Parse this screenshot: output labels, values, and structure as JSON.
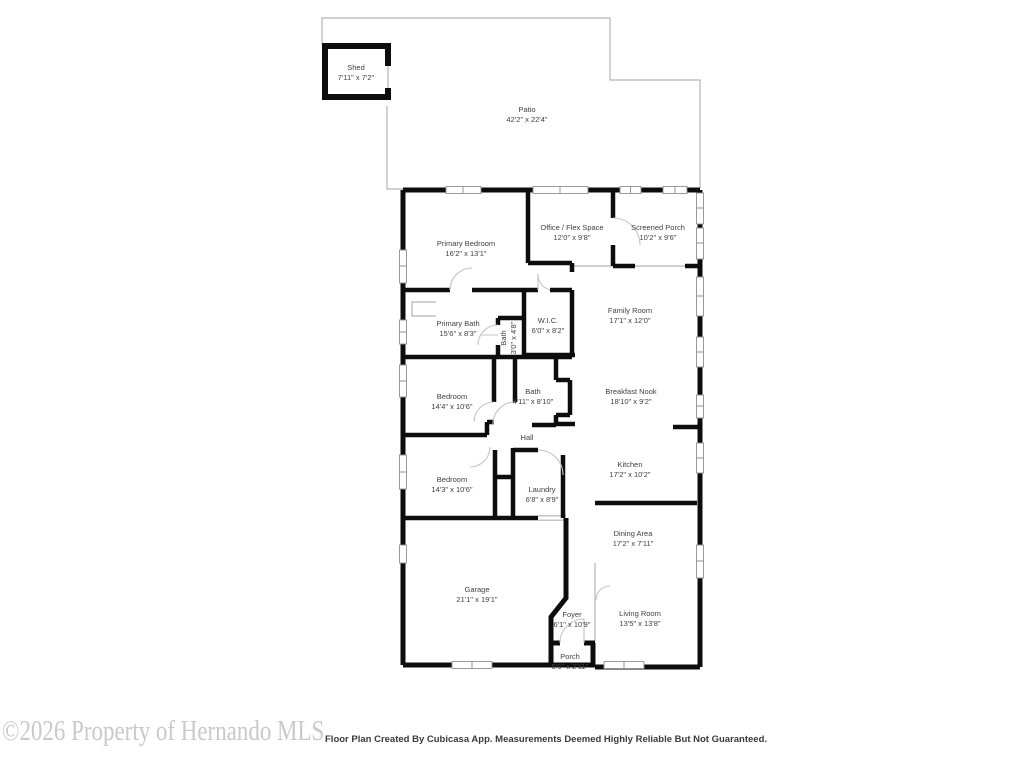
{
  "footer": {
    "watermark": "©2026 Property of Hernando MLS",
    "disclaimer": "Floor Plan Created By Cubicasa App. Measurements Deemed Highly Reliable But Not Guaranteed."
  },
  "colors": {
    "wall": "#0d0d0d",
    "window_outline": "#8f8f8f",
    "patio_outline": "#b3b3b3",
    "label_text": "#3f3f3f",
    "watermark_text": "#c9c9c9",
    "disclaimer_text": "#3a3a3a"
  },
  "rooms": [
    {
      "name": "Shed",
      "dims": "7'11\" x 7'2\""
    },
    {
      "name": "Patio",
      "dims": "42'2\" x 22'4\""
    },
    {
      "name": "Primary Bedroom",
      "dims": "16'2\" x 13'1\""
    },
    {
      "name": "Office / Flex Space",
      "dims": "12'0\" x 9'8\""
    },
    {
      "name": "Screened Porch",
      "dims": "10'2\" x 9'6\""
    },
    {
      "name": "Family Room",
      "dims": "17'1\" x 12'0\""
    },
    {
      "name": "Primary Bath",
      "dims": "15'6\" x 8'3\""
    },
    {
      "name": "Bath",
      "dims": "3'0\" x 4'8\""
    },
    {
      "name": "W.I.C.",
      "dims": "6'0\" x 8'2\""
    },
    {
      "name": "Bedroom",
      "dims": "14'4\" x 10'6\""
    },
    {
      "name": "Bath",
      "dims": "4'11\" x 8'10\""
    },
    {
      "name": "Breakfast Nook",
      "dims": "18'10\" x 9'2\""
    },
    {
      "name": "Hall",
      "dims": ""
    },
    {
      "name": "Bedroom",
      "dims": "14'3\" x 10'6\""
    },
    {
      "name": "Laundry",
      "dims": "6'8\" x 8'9\""
    },
    {
      "name": "Kitchen",
      "dims": "17'2\" x 10'2\""
    },
    {
      "name": "Dining Area",
      "dims": "17'2\" x 7'11\""
    },
    {
      "name": "Garage",
      "dims": "21'1\" x 19'1\""
    },
    {
      "name": "Foyer",
      "dims": "6'1\" x 10'9\""
    },
    {
      "name": "Living Room",
      "dims": "13'5\" x 13'8\""
    },
    {
      "name": "Porch",
      "dims": "5'6\" x 2'11\""
    }
  ]
}
